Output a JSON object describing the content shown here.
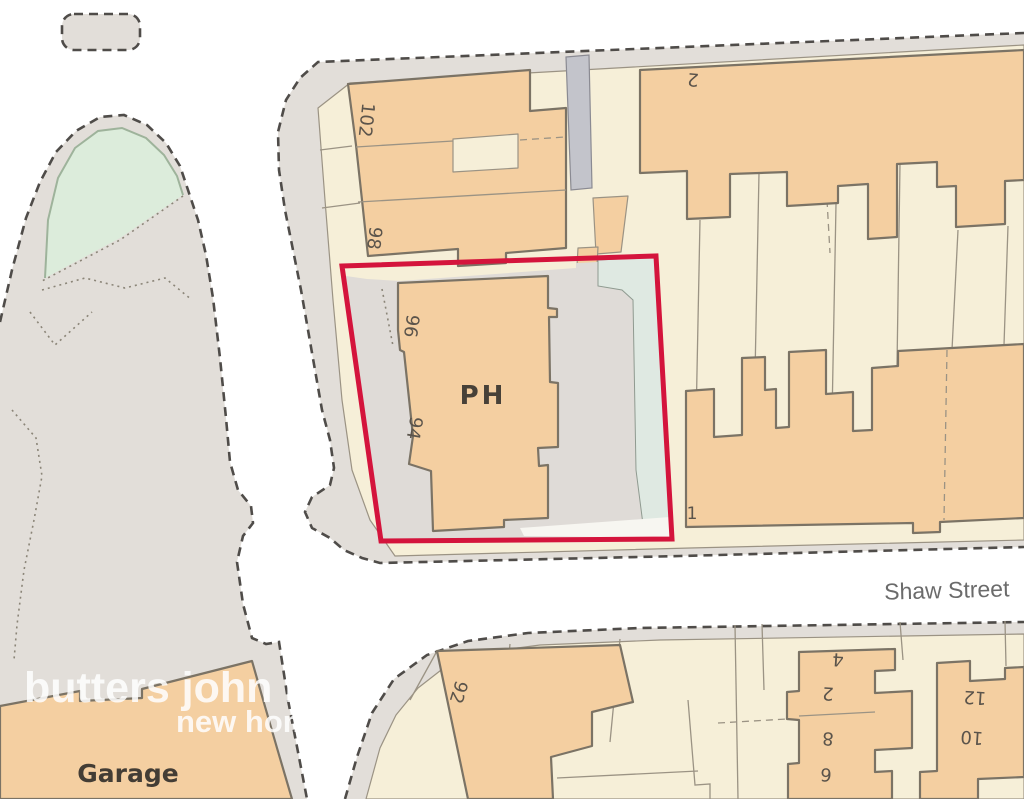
{
  "map": {
    "street": {
      "name": "Shaw Street"
    },
    "labels": {
      "ph": "PH",
      "garage": "Garage",
      "no_102": "102",
      "no_98": "98",
      "no_96": "96",
      "no_94": "94",
      "no_92": "92",
      "no_2_north": "2",
      "no_1": "1",
      "no_4": "4",
      "no_2_south": "2",
      "no_8": "8",
      "no_6": "6",
      "no_12": "12",
      "no_10": "10"
    },
    "watermark": {
      "line1": "butters john bee",
      "line2": "new homes"
    },
    "colors": {
      "building_fill": "#f4cfa1",
      "parcel_fill": "#f6efd8",
      "paved_fill": "#e2ded9",
      "road_fill": "#c3c4cb",
      "green_fill": "#dcecdb",
      "plot_outline": "#d4143c",
      "boundary_dash": "#4f4c49"
    }
  }
}
